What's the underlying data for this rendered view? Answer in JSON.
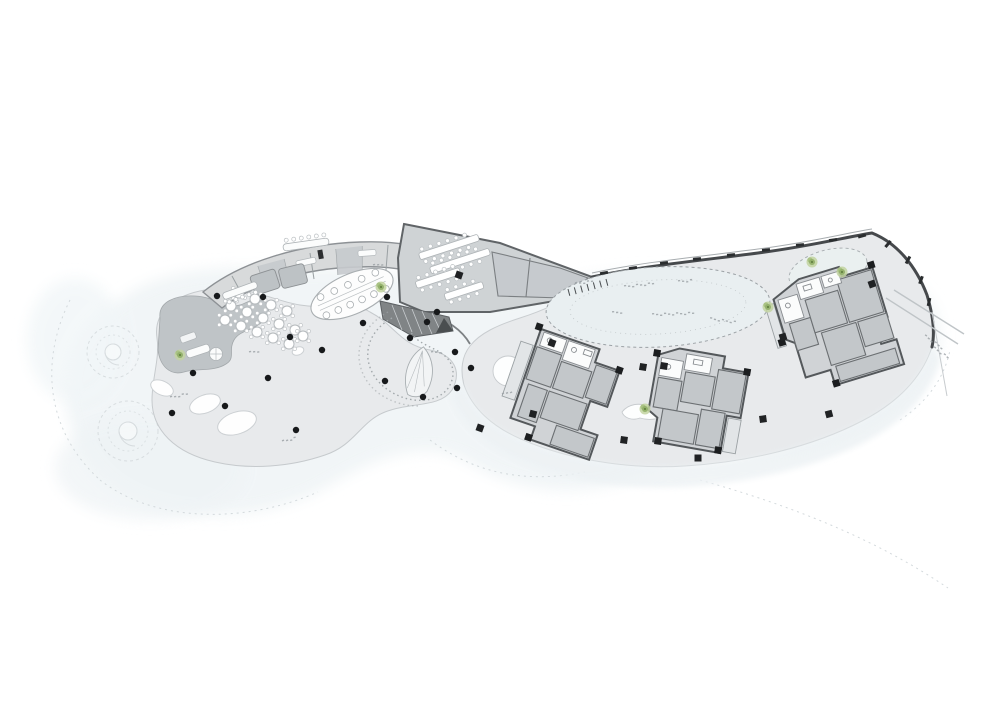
{
  "document": {
    "kind_label": ""
  },
  "colors": {
    "paper": "#ffffff",
    "landscape_tint": "#ecf2f4",
    "terrace": "#e8eaec",
    "plaza": "#e8eaec",
    "band_building": "#d8dadb",
    "hall_fill": "#cfd3d5",
    "hall_room": "#c6cace",
    "unit_fill": "#d0d3d6",
    "unit_room": "#c3c7ca",
    "balcony": "#e2e5e7",
    "wall_dark": "#46494c",
    "column_black": "#17191b",
    "tree_green": "#8fae66",
    "stair_wedge": "#808486",
    "dash_gray": "#9aa0a4"
  },
  "plan": {
    "round_columns": [
      [
        217,
        296
      ],
      [
        263,
        297
      ],
      [
        290,
        337
      ],
      [
        322,
        350
      ],
      [
        363,
        323
      ],
      [
        193,
        373
      ],
      [
        268,
        378
      ],
      [
        225,
        406
      ],
      [
        172,
        413
      ],
      [
        296,
        430
      ],
      [
        385,
        381
      ],
      [
        423,
        397
      ],
      [
        457,
        388
      ],
      [
        471,
        368
      ],
      [
        455,
        352
      ],
      [
        427,
        322
      ],
      [
        437,
        312
      ],
      [
        387,
        297
      ],
      [
        410,
        338
      ]
    ],
    "square_columns": [
      [
        552,
        343,
        20
      ],
      [
        643,
        367,
        10
      ],
      [
        664,
        366,
        10
      ],
      [
        624,
        440,
        8
      ],
      [
        658,
        441,
        8
      ],
      [
        763,
        419,
        -8
      ],
      [
        829,
        414,
        -15
      ],
      [
        783,
        337,
        -17
      ],
      [
        872,
        284,
        -20
      ],
      [
        533,
        414,
        15
      ],
      [
        480,
        428,
        20
      ],
      [
        459,
        275,
        19
      ],
      [
        698,
        458,
        0
      ]
    ],
    "wall_ticks": [
      [
        604,
        273,
        -10
      ],
      [
        633,
        268,
        -8
      ],
      [
        664,
        263,
        -7
      ],
      [
        697,
        259,
        -6
      ],
      [
        731,
        255,
        -5
      ],
      [
        766,
        250,
        -5
      ],
      [
        800,
        245,
        -6
      ],
      [
        833,
        240,
        -8
      ],
      [
        862,
        236,
        -15
      ],
      [
        888,
        244,
        -50
      ],
      [
        908,
        260,
        -62
      ],
      [
        921,
        280,
        -70
      ],
      [
        929,
        302,
        -78
      ]
    ],
    "comb": {
      "x1": 568,
      "y1": 289,
      "x2": 606,
      "y2": 279,
      "n": 7,
      "len": 7
    },
    "round_tables": [
      [
        231,
        306
      ],
      [
        247,
        312
      ],
      [
        263,
        318
      ],
      [
        279,
        324
      ],
      [
        295,
        330
      ],
      [
        239,
        293
      ],
      [
        255,
        299
      ],
      [
        271,
        305
      ],
      [
        287,
        311
      ],
      [
        225,
        320
      ],
      [
        241,
        326
      ],
      [
        257,
        332
      ],
      [
        273,
        338
      ],
      [
        289,
        344
      ],
      [
        303,
        336
      ]
    ],
    "counters": [
      {
        "x": 222,
        "y": 287,
        "w": 36,
        "h": 7,
        "rot": -20,
        "chairs": 5,
        "side": 1
      },
      {
        "x": 283,
        "y": 241,
        "w": 46,
        "h": 7,
        "rot": -8,
        "chairs": 6,
        "side": -1
      }
    ],
    "buffet": {
      "cx": 352,
      "cy": 294,
      "rx": 44,
      "ry": 20,
      "rot": -24,
      "stools_top": 5,
      "stools_bottom": 6
    },
    "dining_tables": [
      [
        449,
        247,
        -18,
        62
      ],
      [
        460,
        261,
        -18,
        62
      ],
      [
        438,
        278,
        -18,
        46
      ],
      [
        464,
        291,
        -18,
        40
      ]
    ],
    "trees": [
      [
        180,
        355
      ],
      [
        381,
        287
      ],
      [
        768,
        307
      ],
      [
        812,
        262
      ],
      [
        842,
        272
      ],
      [
        645,
        409
      ]
    ],
    "white_ovals": [
      [
        162,
        388,
        12,
        7,
        25
      ],
      [
        205,
        404,
        16,
        9,
        -20
      ],
      [
        237,
        423,
        20,
        11,
        -18
      ],
      [
        298,
        351,
        6,
        4,
        -20
      ]
    ],
    "annotations": [
      [
        575,
        283,
        -8,
        20
      ],
      [
        624,
        286,
        -6,
        34
      ],
      [
        678,
        281,
        -5,
        16
      ],
      [
        612,
        312,
        -3,
        12
      ],
      [
        652,
        314,
        -2,
        44
      ],
      [
        710,
        318,
        8,
        28
      ],
      [
        925,
        335,
        35,
        26
      ],
      [
        934,
        347,
        35,
        22
      ],
      [
        249,
        352,
        -10,
        14
      ],
      [
        170,
        397,
        -12,
        20
      ],
      [
        282,
        441,
        -15,
        18
      ],
      [
        431,
        352,
        -5,
        14
      ],
      [
        373,
        265,
        -10,
        12
      ],
      [
        502,
        394,
        -20,
        10
      ]
    ]
  }
}
